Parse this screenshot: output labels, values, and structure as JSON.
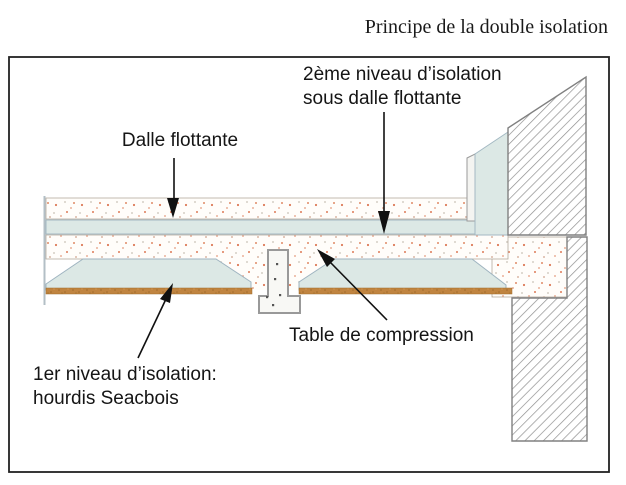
{
  "page": {
    "title": "Principe de la double isolation"
  },
  "diagram": {
    "labels": {
      "second_insulation_line1": "2ème niveau d’isolation",
      "second_insulation_line2": "sous dalle flottante",
      "floating_slab": "Dalle flottante",
      "compression_table": "Table de compression",
      "first_insulation_line1": "1er niveau d’isolation:",
      "first_insulation_line2": "hourdis Seacbois"
    },
    "colors": {
      "insulation_blue": "#dce8e5",
      "concrete_speckle_red": "#dd7a58",
      "wood_brown": "#c08440",
      "wall_hatch_gray": "#8f8f8f",
      "frame_border": "#222222"
    }
  }
}
